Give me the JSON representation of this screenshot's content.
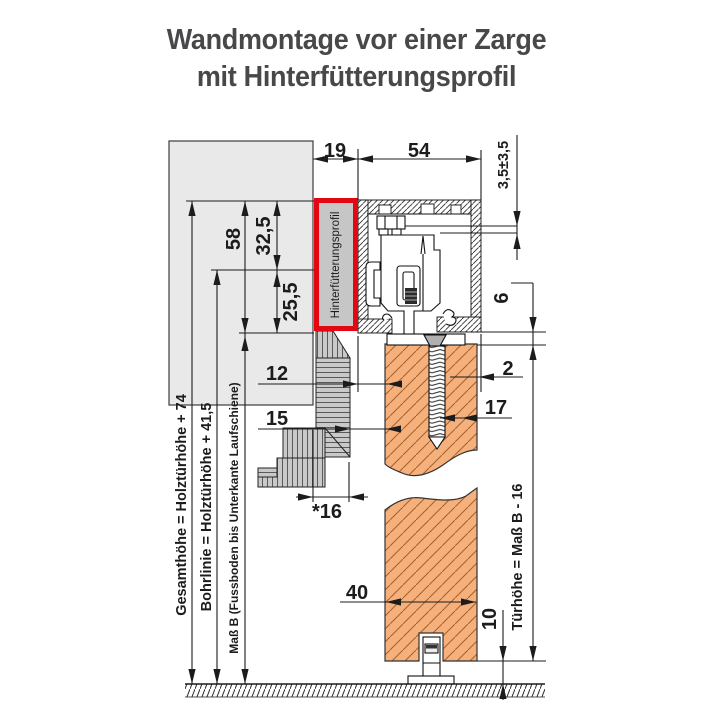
{
  "title": {
    "line1": "Wandmontage vor einer Zarge",
    "line2": "mit Hinterfütterungsprofil"
  },
  "annotations": {
    "hinterfuetterungsprofil": "Hinterfütterungsprofil",
    "gesamthoehe": "Gesamthöhe = Holztürhöhe + 74",
    "bohrlinie": "Bohrlinie = Holztürhöhe + 41,5",
    "mass_b": "Maß B (Fussboden bis Unterkante Laufschiene)",
    "tuerhoehe": "Türhöhe = Maß B - 16"
  },
  "dims": {
    "hinterfuetterung_width": "19",
    "laufschiene_width": "54",
    "height_adjustment": "3,5±3,5",
    "profile_total_height": "58",
    "profile_upper": "32,5",
    "profile_lower": "25,5",
    "track_to_door": "12",
    "zarge_offset": "15",
    "door_face_offset": "2",
    "screw_depth": "17",
    "zarge_depth": "*16",
    "track_to_door_top": "6",
    "door_thickness": "40",
    "floor_clearance": "10"
  },
  "colors": {
    "highlight_red": "#e30613",
    "door_orange": "#f5b07c",
    "wall_gray": "#e9e9e9",
    "profile_gray": "#c6c6c6",
    "frame_gray": "#c9c9c9",
    "line": "#1c1c1c",
    "title_text": "#48484a"
  }
}
